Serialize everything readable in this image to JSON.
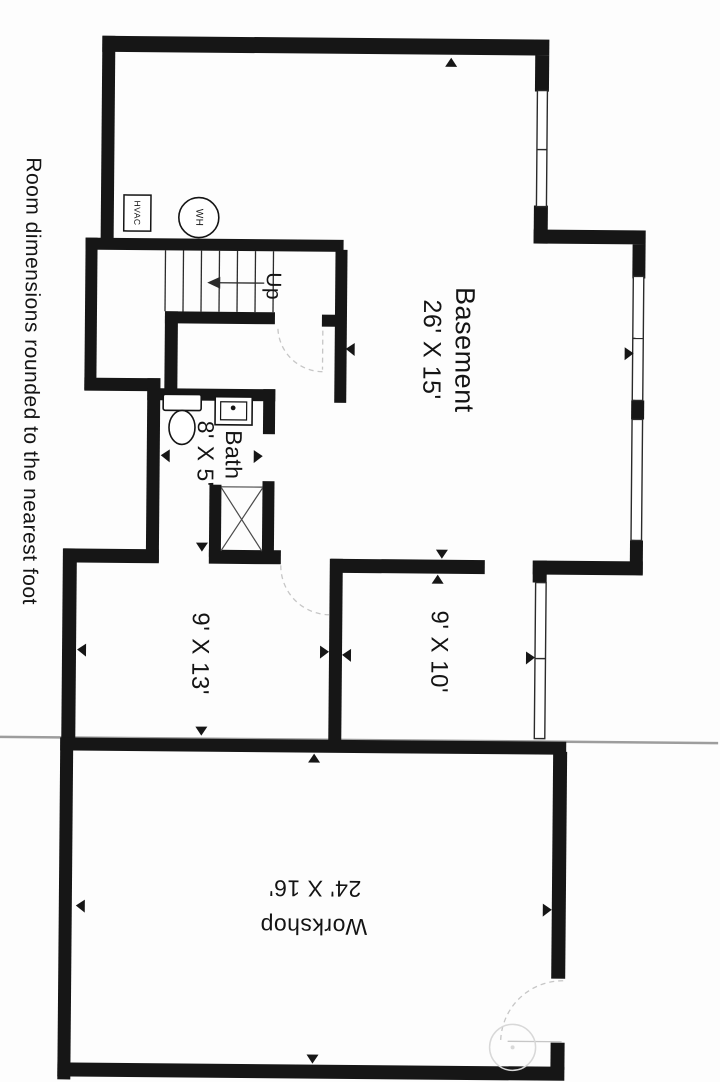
{
  "page": {
    "note": "Room dimensions rounded to the nearest foot"
  },
  "rooms": {
    "basement": {
      "name": "Basement",
      "dims": "26' X 15'"
    },
    "bath": {
      "name": "Bath",
      "dims": "8' X 5'"
    },
    "room_9x13": {
      "dims": "9' X 13'"
    },
    "room_9x10": {
      "dims": "9' X 10'"
    },
    "workshop": {
      "name": "Workshop",
      "dims": "24' X 16'"
    }
  },
  "equipment": {
    "hvac_label": "HVAC",
    "water_heater_label": "WH"
  },
  "stairs": {
    "direction_label": "Up"
  },
  "colors": {
    "wall": "#161616",
    "thin_line": "#2b2b2b",
    "faint": "#c6c6c6",
    "seam": "#9d9d9d",
    "watermark": "#d8d8d8"
  }
}
